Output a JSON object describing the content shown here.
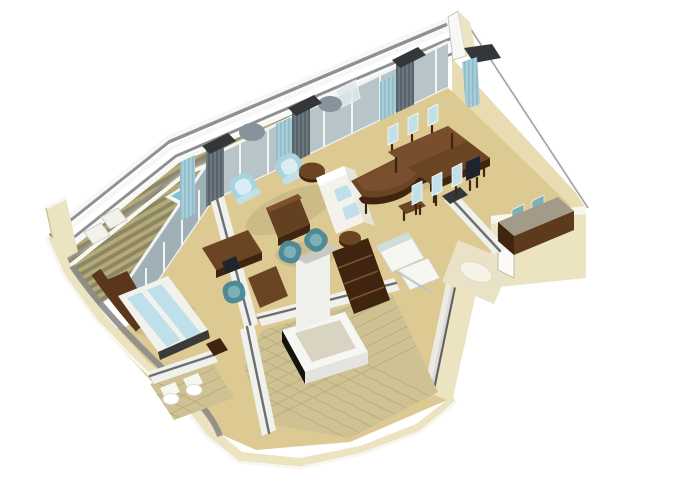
{
  "meta": {
    "title": "Isometric 3D cutaway floor plan of a suite with balcony, living-dining room, bedroom and bathroom",
    "render_style": "3D isometric architectural rendering, white background, no visible text"
  },
  "palette": {
    "bg": "#ffffff",
    "railWhite": "#f7f7f5",
    "railGray": "#8f9092",
    "deckA": "#8d8660",
    "deckB": "#b3aa7c",
    "glass": "#b7c4c8",
    "glassShade": "#9fb0b6",
    "frameWhite": "#f2f4f4",
    "curtainDark": "#6b7880",
    "curtainDarkStripe": "#57646c",
    "curtainLight": "#a8cdd9",
    "capDark": "#34373a",
    "wallCream": "#ece3c0",
    "wallCreamEdge": "#f8f6ee",
    "wallInnerTan": "#e9dcb2",
    "wallWhite": "#f0f0ec",
    "wallTopGray": "#6e6e6e",
    "hullGray": "#8b8b88",
    "floorTan": "#ddca92",
    "tile": "#cfc191",
    "tileLine": "#b3a87c",
    "foyerTile": "#e9e2c6",
    "rug": "#f6f3e6",
    "brown": "#6b4423",
    "brownLight": "#7d5130",
    "brownDark": "#3f2410",
    "blueChair": "#a9d3de",
    "blueChairLight": "#c2e0e8",
    "tealChair": "#4f8b96",
    "tealChairLight": "#7fb0b8",
    "sofa": "#f4f2ea",
    "sofaShade": "#e6e4d8",
    "credenzaTop": "#a39a88",
    "bedBlue": "#bfe0ea",
    "bedWhite": "#f2f2ec",
    "fixtureWhite": "#f6f6f3",
    "tubInner": "#d9d3c2",
    "whirlpoolWater": "#7ec3da",
    "headboardBrown": "#5a371c",
    "darkChair": "#20242c"
  },
  "scene": {
    "rooms": [
      {
        "id": "balcony",
        "label": "Private balcony with whirlpool and loungers"
      },
      {
        "id": "living",
        "label": "Living room with sofa, armchairs and grand piano"
      },
      {
        "id": "dining",
        "label": "Dining area with table for seven"
      },
      {
        "id": "bedroom",
        "label": "Bedroom with double bed"
      },
      {
        "id": "bathroom",
        "label": "Bathroom with bathtub, vanity and shower"
      },
      {
        "id": "wc",
        "label": "WC with toilet and bidet"
      },
      {
        "id": "closet",
        "label": "Walk-in closet shelving"
      },
      {
        "id": "foyer",
        "label": "Entry foyer with oval rug"
      }
    ],
    "furniture": [
      "stepped balcony railing",
      "teak deck planks",
      "whirlpool tub",
      "deck loungers",
      "floor-to-ceiling window wall with curtains",
      "grand piano with bench",
      "dining table with six upholstered chairs and one dark chair",
      "white sofa with blue cushions",
      "two light-blue armchairs",
      "round side table",
      "brown ottoman coffee table",
      "writing desk with chair",
      "teal tub chairs",
      "credenza with two chairs",
      "double bed with blue runners",
      "nightstand",
      "bathtub",
      "vanity with mirror",
      "shower enclosure",
      "toilet",
      "bidet",
      "wardrobe",
      "closet shelves",
      "oval entry rug"
    ]
  }
}
